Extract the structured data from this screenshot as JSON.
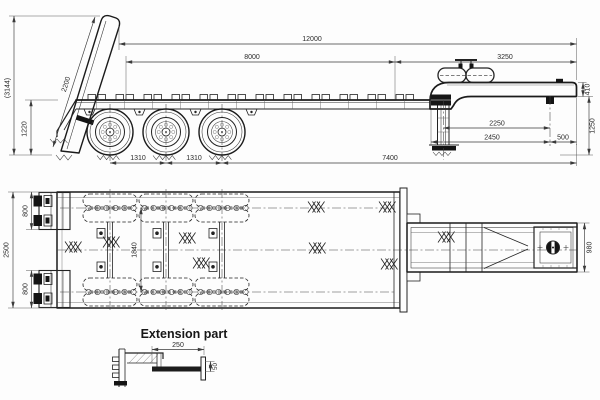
{
  "drawing_title": "Lowbed semi-trailer technical drawing",
  "side_view": {
    "dims": {
      "overall_length": "12000",
      "platform_length": "8000",
      "gooseneck_length": "3250",
      "ramp_length": "2200",
      "overall_height": "(3144)",
      "deck_height": "1220",
      "axle_spacing_front": "1310",
      "axle_spacing_rear": "1310",
      "rear_axle_to_front": "7400",
      "neck_beam_depth": "410",
      "support_to_kingpin": "2250",
      "deck_to_kingpin": "2450",
      "kingpin_setback": "500",
      "fifth_wheel_height": "1250"
    }
  },
  "plan_view": {
    "dims": {
      "ramp_width_top": "800",
      "overall_width": "2500",
      "ramp_width_bottom": "800",
      "tire_track": "1840",
      "neck_width": "980"
    }
  },
  "extension_detail": {
    "title": "Extension part",
    "dims": {
      "length": "250",
      "height": "50"
    }
  }
}
